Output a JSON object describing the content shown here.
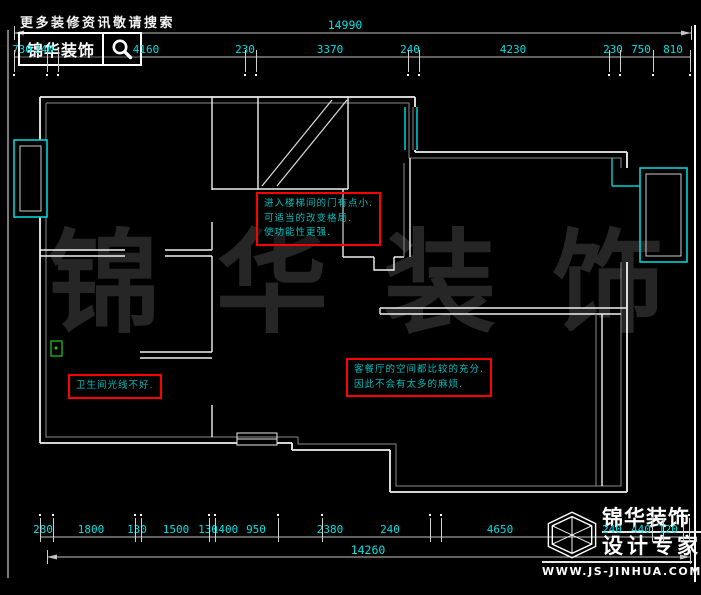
{
  "header": {
    "search_hint": "更多装修资讯敬请搜索",
    "brand": "锦华装饰",
    "search_icon": "magnifier-icon"
  },
  "watermark": {
    "chars": [
      "锦",
      "华",
      "装",
      "饰"
    ]
  },
  "dimensions": {
    "top": {
      "overall": {
        "label": "14990",
        "x": 345,
        "y": 19
      },
      "segments": [
        {
          "label": "730",
          "x": 22,
          "y": 44
        },
        {
          "label": "240",
          "x": 44,
          "y": 44
        },
        {
          "label": "4160",
          "x": 146,
          "y": 44
        },
        {
          "label": "230",
          "x": 245,
          "y": 44
        },
        {
          "label": "3370",
          "x": 330,
          "y": 44
        },
        {
          "label": "240",
          "x": 410,
          "y": 44
        },
        {
          "label": "4230",
          "x": 513,
          "y": 44
        },
        {
          "label": "230",
          "x": 613,
          "y": 44
        },
        {
          "label": "750",
          "x": 641,
          "y": 44
        },
        {
          "label": "810",
          "x": 673,
          "y": 44
        }
      ],
      "boundaries": [
        14,
        47,
        58,
        245,
        256,
        408,
        419,
        609,
        620,
        653,
        690
      ],
      "overall_ends": [
        14,
        691
      ]
    },
    "bottom": {
      "overall": {
        "label": "14260",
        "x": 368,
        "y": 544
      },
      "segments": [
        {
          "label": "280",
          "x": 43,
          "y": 524
        },
        {
          "label": "1800",
          "x": 91,
          "y": 524
        },
        {
          "label": "130",
          "x": 137,
          "y": 524
        },
        {
          "label": "1500",
          "x": 176,
          "y": 524
        },
        {
          "label": "130",
          "x": 208,
          "y": 524
        },
        {
          "label": "1400",
          "x": 225,
          "y": 524
        },
        {
          "label": "950",
          "x": 256,
          "y": 524
        },
        {
          "label": "2380",
          "x": 330,
          "y": 524
        },
        {
          "label": "240",
          "x": 390,
          "y": 524
        },
        {
          "label": "4650",
          "x": 500,
          "y": 524
        },
        {
          "label": "240",
          "x": 612,
          "y": 524
        },
        {
          "label": "440",
          "x": 641,
          "y": 524
        },
        {
          "label": "120",
          "x": 668,
          "y": 524
        }
      ],
      "boundaries": [
        40,
        53,
        135,
        141,
        209,
        215,
        278,
        322,
        430,
        441,
        652,
        663,
        683,
        689
      ],
      "overall_ends": [
        47,
        690
      ]
    }
  },
  "annotations": [
    {
      "x": 256,
      "y": 192,
      "lines": [
        "进入楼梯间的门有点小.",
        "可适当的改变格局.",
        "使功能性更强."
      ]
    },
    {
      "x": 346,
      "y": 358,
      "lines": [
        "客餐厅的空间都比较的充分.",
        "因此不会有太多的麻烦."
      ]
    },
    {
      "x": 68,
      "y": 374,
      "lines": [
        "卫生间光线不好."
      ]
    }
  ],
  "footer_logo": {
    "icon": "hexagon-cube-icon",
    "company": "锦华装饰",
    "tagline": "设计专家",
    "website": "WWW.JS-JINHUA.COM"
  },
  "colors": {
    "background": "#000000",
    "wall": "#f0f0f0",
    "wall_inner": "#8a8a8a",
    "window": "#00d4d4",
    "dimension_text": "#00e0e0",
    "dimension_line": "#c4c4c4",
    "annotation_border": "#ff0000",
    "annotation_text": "#00bdbd",
    "watermark": "#262626",
    "fixture_green": "#1ecb1e"
  }
}
